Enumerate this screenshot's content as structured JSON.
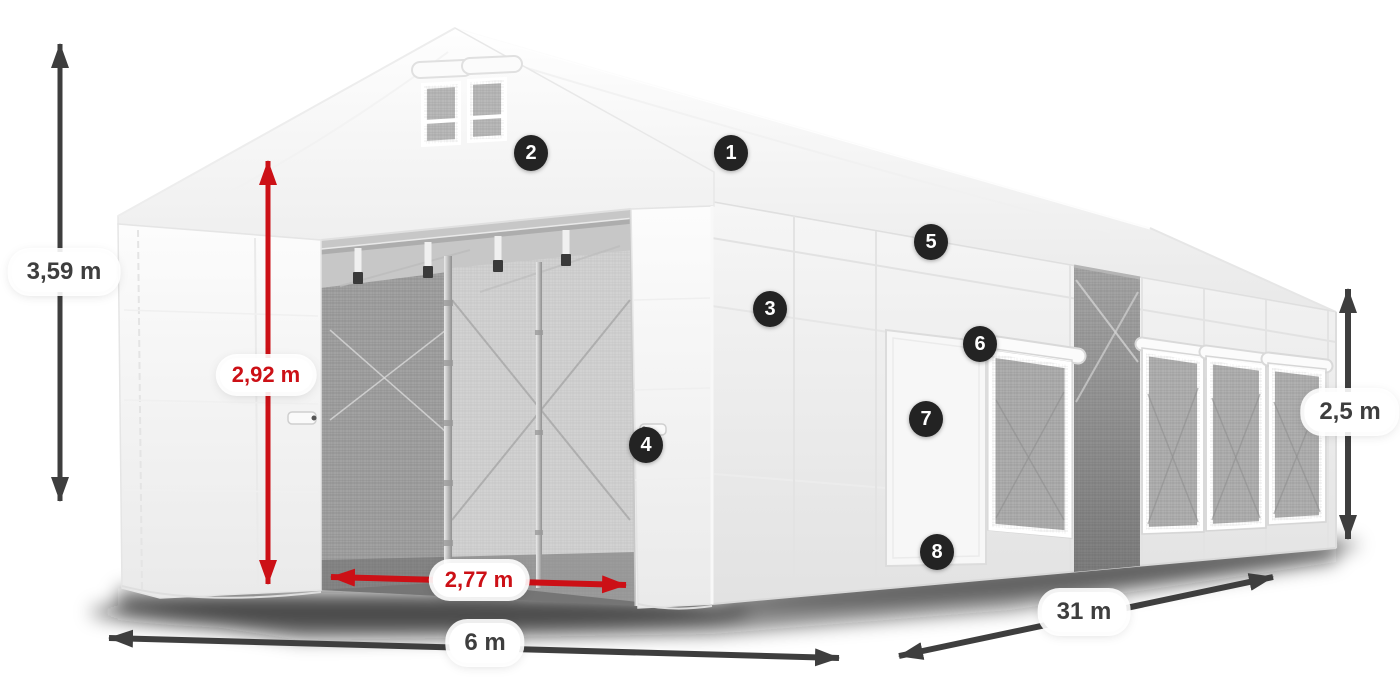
{
  "diagram": {
    "kind": "tent-dimension-diagram",
    "background": "#ffffff"
  },
  "colors": {
    "dimension_dark": "#3e3e3e",
    "dimension_red": "#cc1016",
    "callout_background": "#232323",
    "callout_text": "#ffffff",
    "pill_background": "#ffffff"
  },
  "dimensions": {
    "total_height": {
      "label": "3,59 m",
      "style": "dark"
    },
    "inner_height": {
      "label": "2,92 m",
      "style": "red"
    },
    "door_width": {
      "label": "2,77 m",
      "style": "red"
    },
    "width": {
      "label": "6 m",
      "style": "dark"
    },
    "length": {
      "label": "31 m",
      "style": "dark"
    },
    "side_height": {
      "label": "2,5 m",
      "style": "dark"
    }
  },
  "callouts": [
    {
      "label": "1"
    },
    {
      "label": "2"
    },
    {
      "label": "3"
    },
    {
      "label": "4"
    },
    {
      "label": "5"
    },
    {
      "label": "6"
    },
    {
      "label": "7"
    },
    {
      "label": "8"
    }
  ]
}
